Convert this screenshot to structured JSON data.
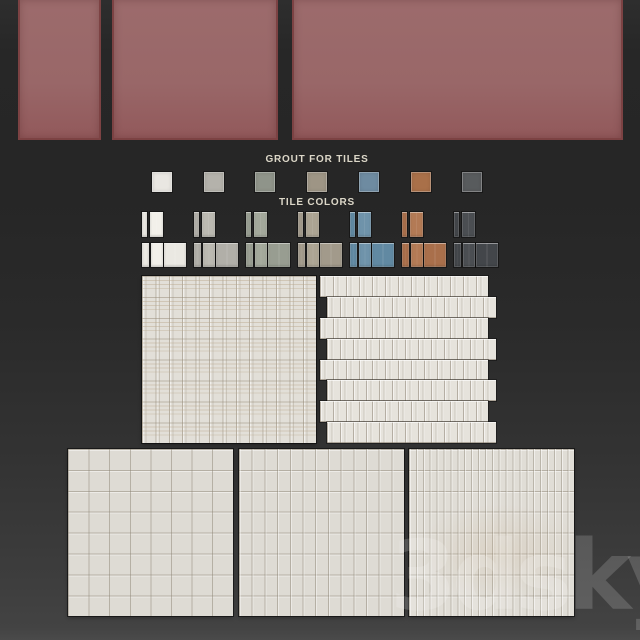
{
  "header_panels": {
    "color": "#996768",
    "border_color": "#7c4243",
    "count": 3
  },
  "grout": {
    "label": "GROUT FOR TILES",
    "swatches": [
      {
        "name": "white",
        "color": "#e9e7e2"
      },
      {
        "name": "light-gray",
        "color": "#b4b2ab"
      },
      {
        "name": "sage-gray",
        "color": "#8f948a"
      },
      {
        "name": "taupe",
        "color": "#9e9585"
      },
      {
        "name": "steel-blue",
        "color": "#6e8ba1"
      },
      {
        "name": "terracotta",
        "color": "#a97049"
      },
      {
        "name": "charcoal",
        "color": "#585b5d"
      }
    ]
  },
  "tile_colors": {
    "label": "TILE COLORS",
    "groups": [
      {
        "name": "white",
        "base": "#eae8e2",
        "light": "#f2f0ea"
      },
      {
        "name": "light-gray",
        "base": "#b1afa8",
        "light": "#bbb9b1"
      },
      {
        "name": "sage-gray",
        "base": "#989d91",
        "light": "#a3a89b"
      },
      {
        "name": "taupe",
        "base": "#a29a8b",
        "light": "#aca493"
      },
      {
        "name": "steel-blue",
        "base": "#6189a2",
        "light": "#6f93aa"
      },
      {
        "name": "terracotta",
        "base": "#a96f4b",
        "light": "#b37a55"
      },
      {
        "name": "charcoal",
        "base": "#43464a",
        "light": "#4b4e52"
      }
    ]
  },
  "sample_panels": {
    "tile_color": "#e2dfd8",
    "grout_line_color": "#8c8474",
    "offset_rows": 8
  },
  "watermark": {
    "text": "3dsky"
  }
}
